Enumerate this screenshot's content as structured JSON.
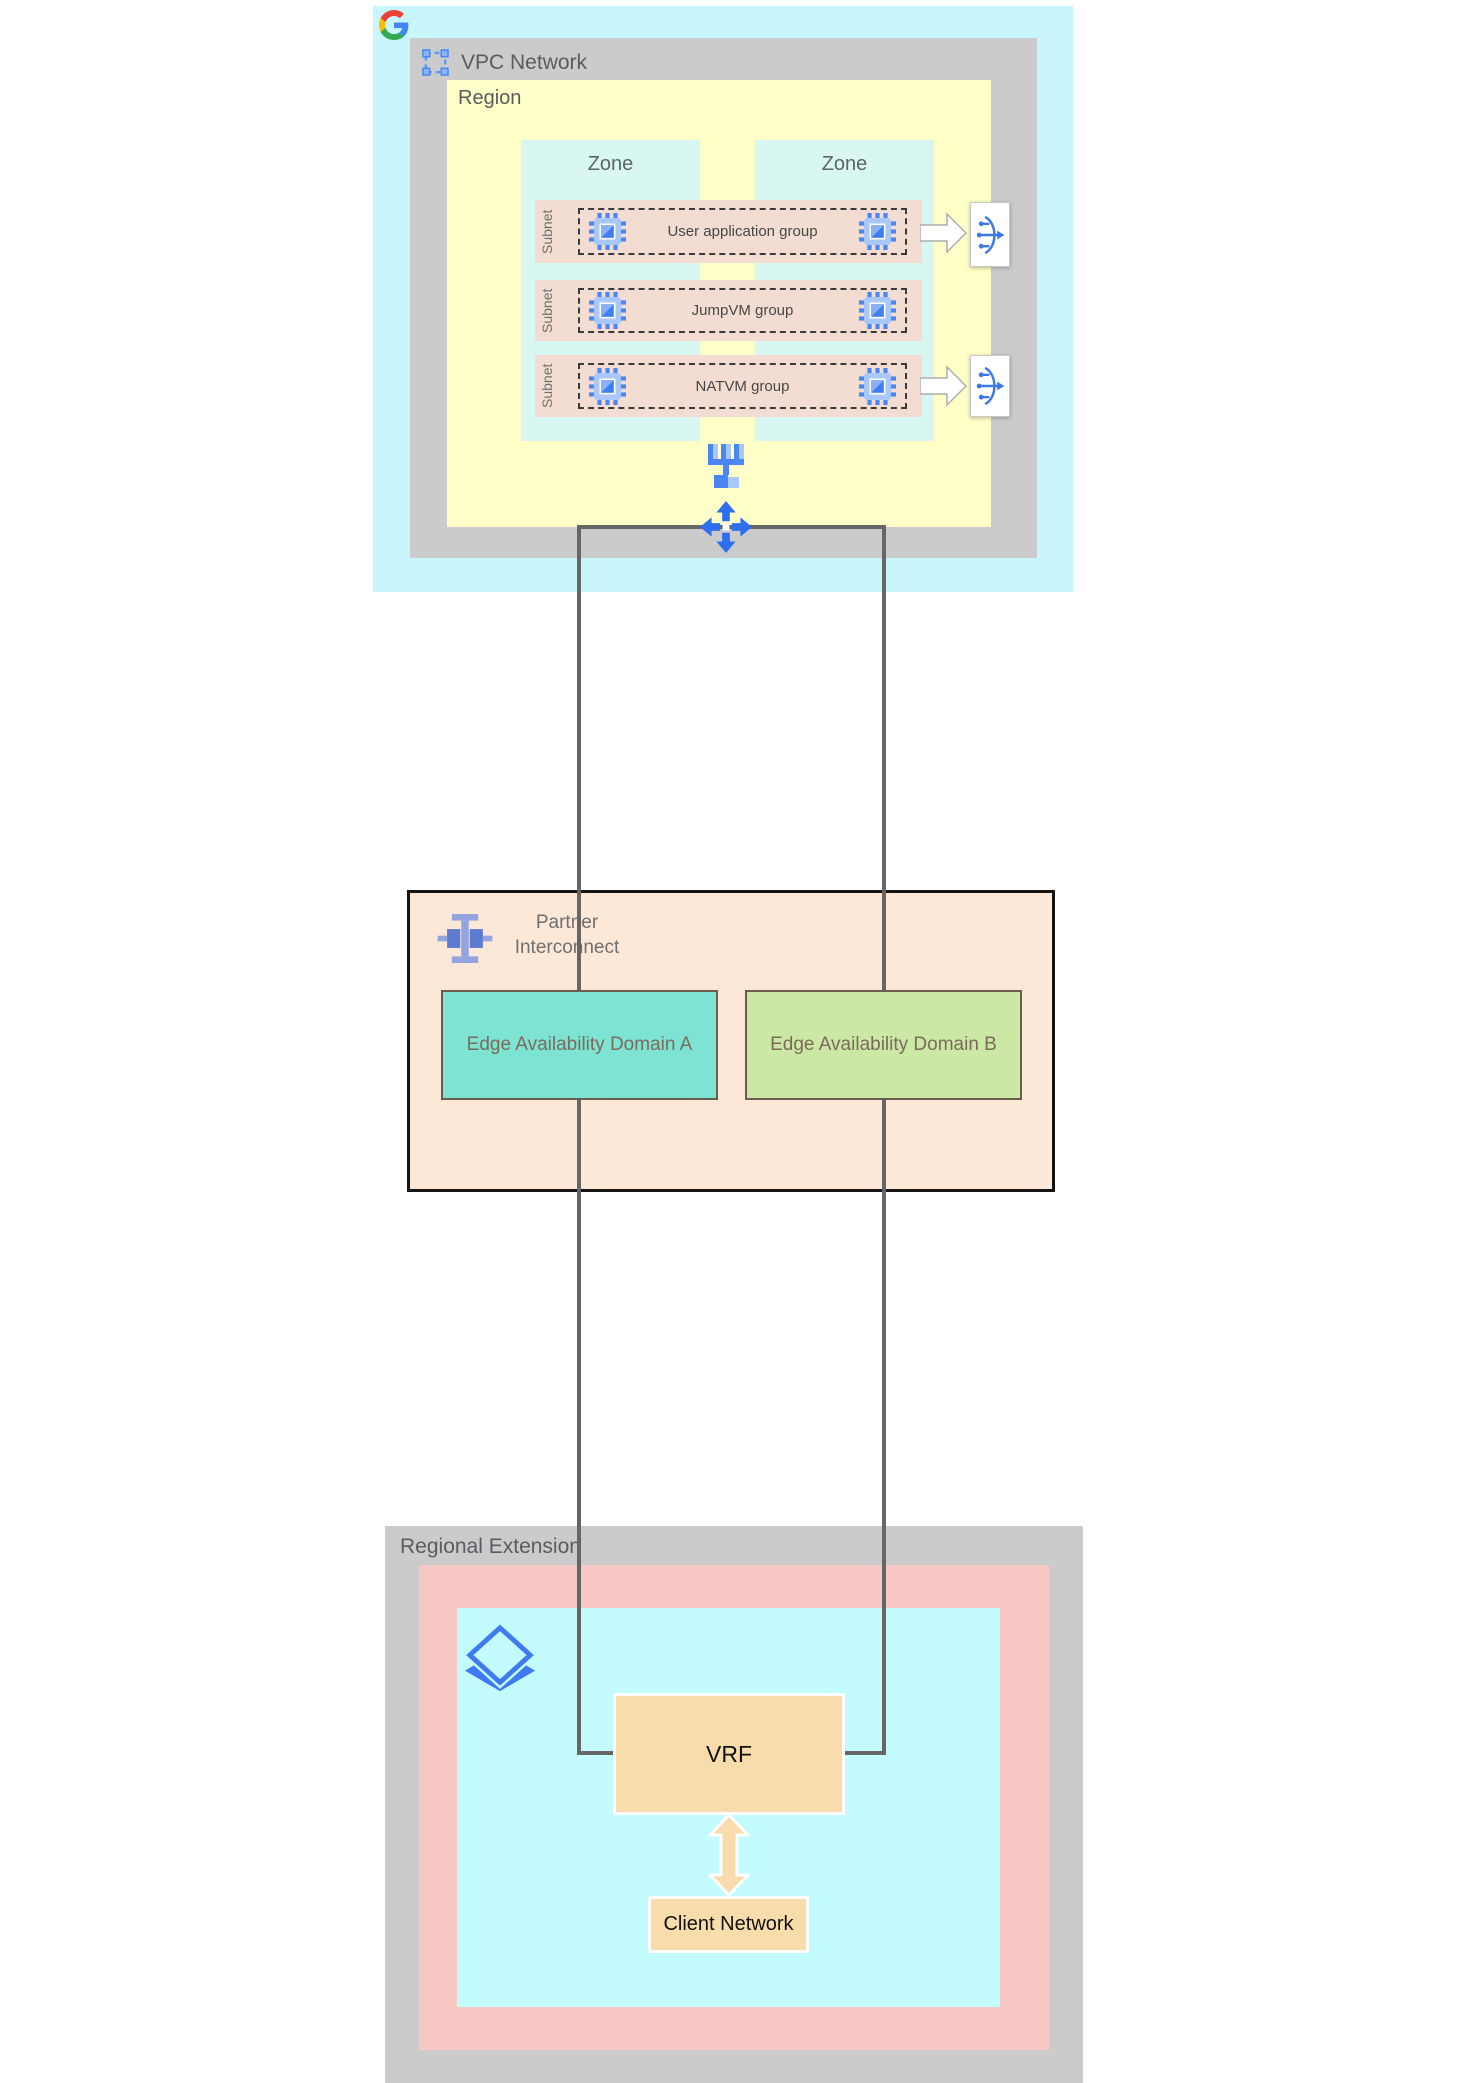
{
  "vpc": {
    "title": "VPC Network",
    "region": {
      "title": "Region",
      "zones": [
        {
          "label": "Zone"
        },
        {
          "label": "Zone"
        }
      ],
      "subnets": [
        {
          "side_label": "Subnet",
          "group_label": "User application group",
          "has_load_balancer": true
        },
        {
          "side_label": "Subnet",
          "group_label": "JumpVM group",
          "has_load_balancer": false
        },
        {
          "side_label": "Subnet",
          "group_label": "NATVM group",
          "has_load_balancer": true
        }
      ]
    }
  },
  "partner_interconnect": {
    "label_line1": "Partner",
    "label_line2": "Interconnect",
    "edge_domains": [
      {
        "label": "Edge Availability Domain A"
      },
      {
        "label": "Edge Availability Domain B"
      }
    ]
  },
  "regional_extension": {
    "title": "Regional Extension",
    "vrf_label": "VRF",
    "client_network_label": "Client Network"
  },
  "icons": {
    "google_logo": "google-g",
    "vpc_network": "selection-frame",
    "vm": "compute-engine-chip",
    "load_balancer": "load-balancer",
    "network_tree": "network-topology",
    "routes": "four-way-arrows",
    "partner_interconnect": "interconnect-beam",
    "peering_edge": "diamond-layers",
    "flow_arrow": "block-arrow-right",
    "bidirectional_arrow": "block-arrow-vertical"
  },
  "colors": {
    "vpc_background": "#c8f6fc",
    "frame_gray": "#cbcbcb",
    "region_yellow": "#ffffc8",
    "zone_cyan": "#d9f7f2",
    "subnet_pink": "#f3ddd3",
    "icon_blue": "#4c86f5",
    "icon_blue_light": "#a8c7fa",
    "lb_blue": "#3b78e8",
    "partner_peach": "#fde7d7",
    "domain_a_teal": "#7de4d3",
    "domain_b_green": "#cce8a5",
    "extension_pink": "#f8c8c5",
    "extension_cyan": "#c3fbff",
    "vrf_orange": "#f8dcab",
    "connector_gray": "#666666",
    "label_gray": "#5f6368"
  }
}
